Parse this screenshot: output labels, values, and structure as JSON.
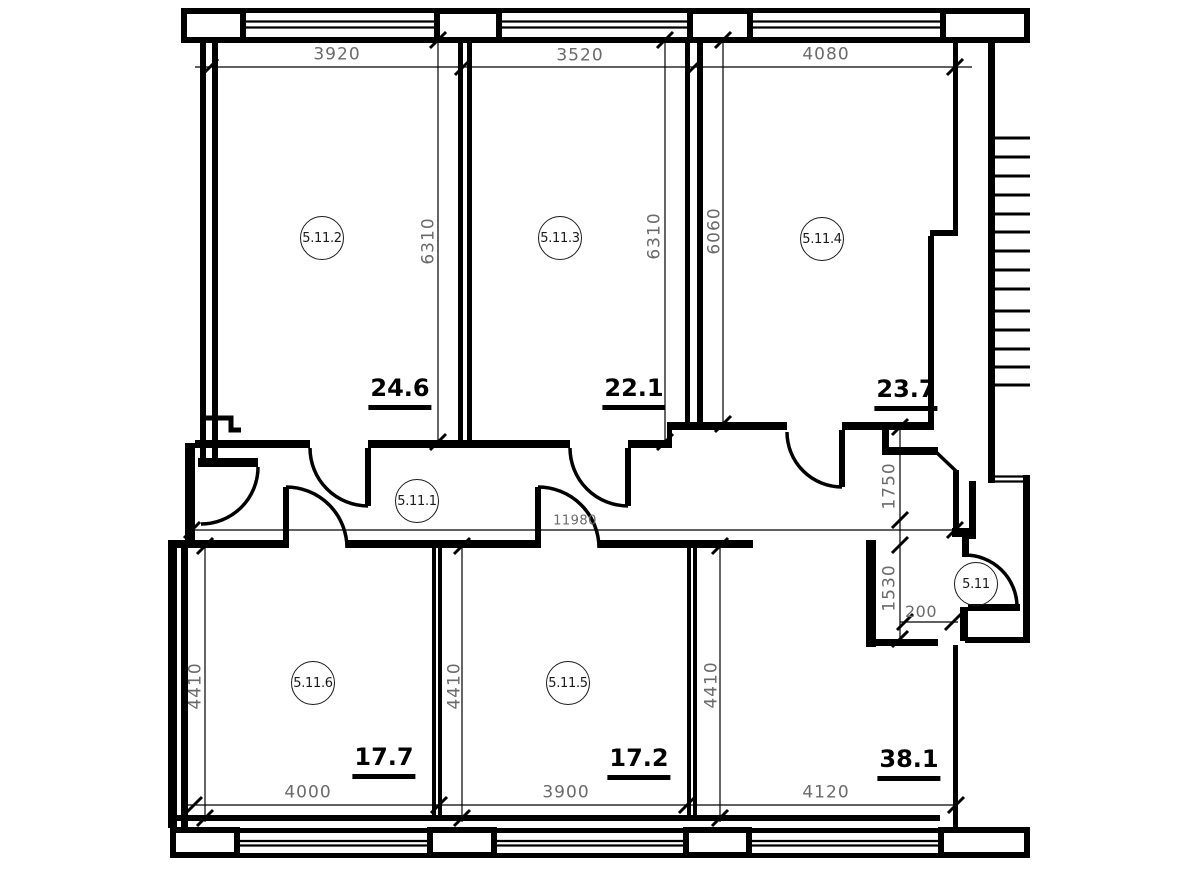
{
  "colors": {
    "wall": "#000000",
    "dim_text": "#6a6a6a",
    "label_text": "#1a1a1a",
    "area_text": "#000000",
    "background": "#ffffff"
  },
  "rooms": {
    "r2": {
      "label": "5.11.2",
      "area": "24.6"
    },
    "r3": {
      "label": "5.11.3",
      "area": "22.1"
    },
    "r4": {
      "label": "5.11.4",
      "area": "23.7"
    },
    "corridor": {
      "label": "5.11.1"
    },
    "vestibule": {
      "label": "5.11"
    },
    "r6": {
      "label": "5.11.6",
      "area": "17.7"
    },
    "r5": {
      "label": "5.11.5",
      "area": "17.2"
    },
    "hall": {
      "area": "38.1"
    }
  },
  "dimensions": {
    "top_widths": [
      "3920",
      "3520",
      "4080"
    ],
    "upper_room_depths": [
      "6310",
      "6310",
      "6060"
    ],
    "corridor_length": "11980",
    "right_side": [
      "1750",
      "1530",
      "200"
    ],
    "bottom_widths": [
      "4000",
      "3900",
      "4120"
    ],
    "lower_room_depths": [
      "4410",
      "4410",
      "4410"
    ]
  }
}
